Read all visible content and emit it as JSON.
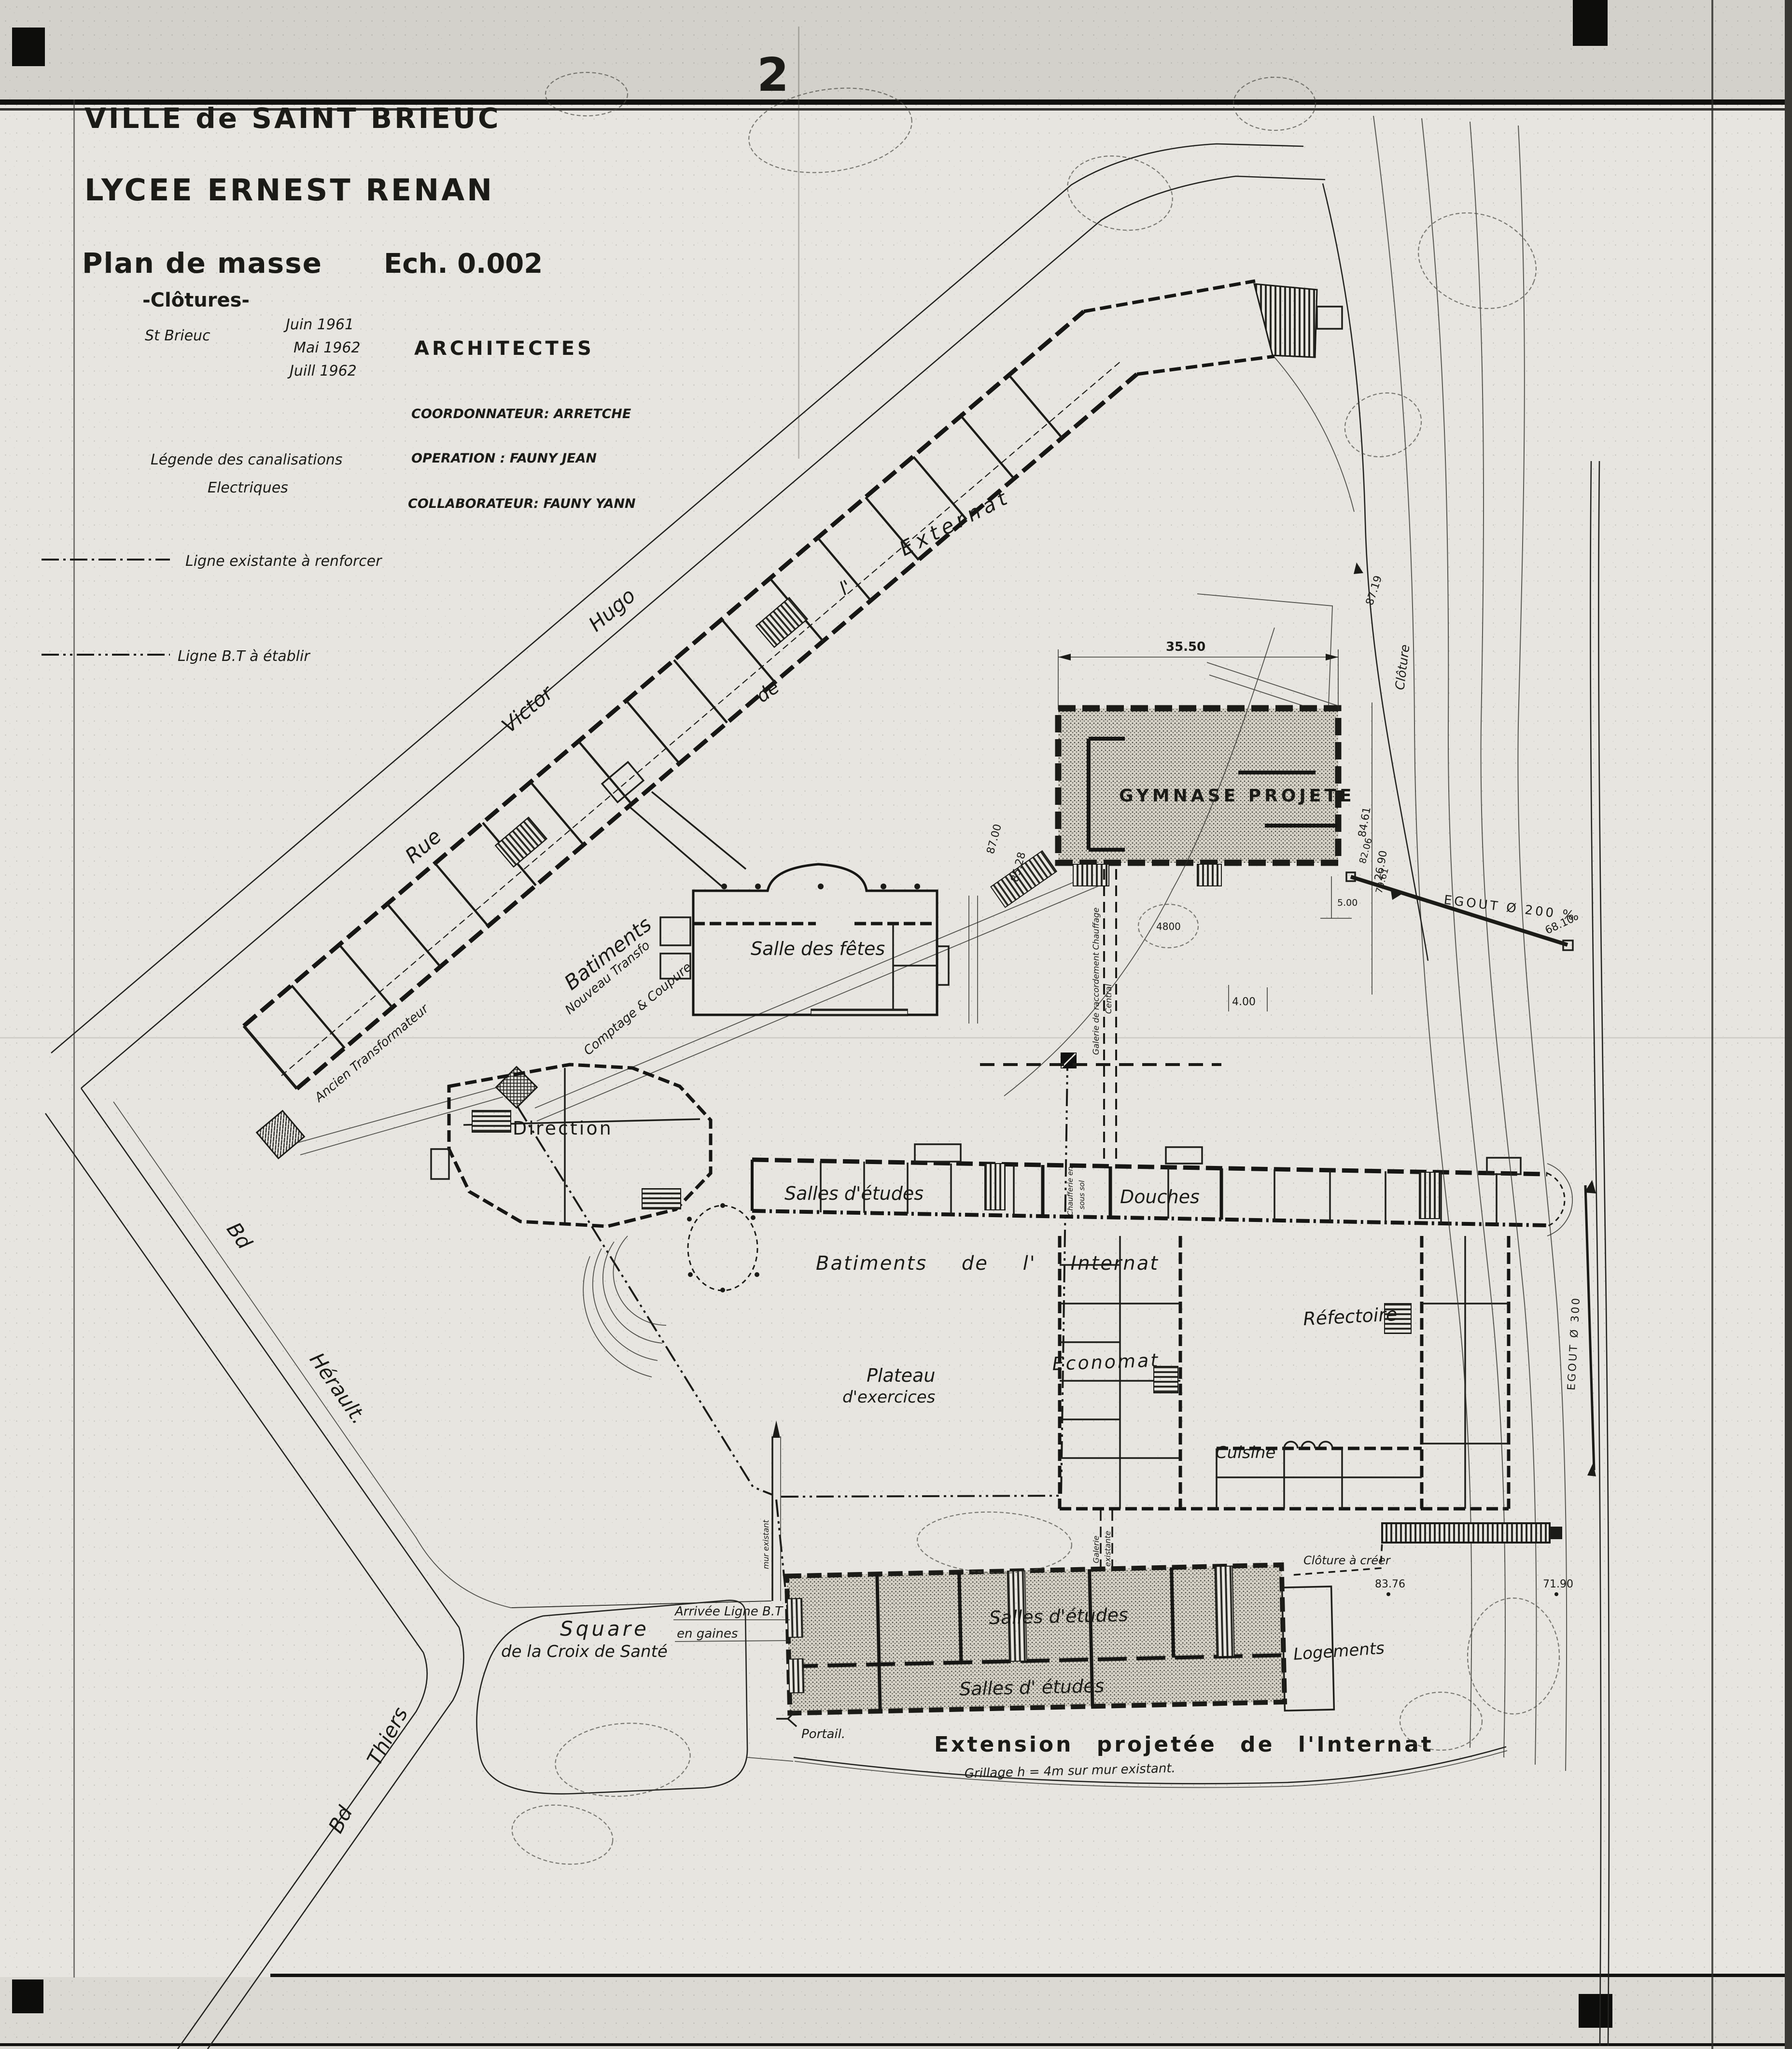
{
  "page": {
    "sheet_number": "2"
  },
  "title_block": {
    "city": "VILLE de SAINT BRIEUC",
    "school": "LYCEE ERNEST RENAN",
    "plan_title": "Plan de masse",
    "plan_subtitle": "-Clôtures-",
    "scale": "Ech. 0.002",
    "place": "St Brieuc",
    "date1": "Juin 1961",
    "date2": "Mai 1962",
    "date3": "Juill 1962",
    "architects_heading": "ARCHITECTES",
    "architect_role1": "COORDONNATEUR: ARRETCHE",
    "architect_role2": "OPERATION : FAUNY JEAN",
    "architect_role3": "COLLABORATEUR: FAUNY YANN"
  },
  "legend": {
    "title_line1": "Légende des canalisations",
    "title_line2": "Electriques",
    "item1": "Ligne existante à renforcer",
    "item2": "Ligne B.T à établir"
  },
  "streets": {
    "rue": "Rue",
    "victor": "Victor",
    "hugo": "Hugo",
    "herault_bd": "Bd",
    "herault_name": "Hérault.",
    "thiers_bd": "Bd",
    "thiers_name": "Thiers"
  },
  "externat": {
    "word1": "Batiments",
    "word2": "de",
    "word3": "l'",
    "word4": "Externat"
  },
  "buildings": {
    "gymnase": "GYMNASE PROJETE",
    "salle_des_fetes": "Salle des fêtes",
    "direction": "Direction",
    "salles_etudes": "Salles d'études",
    "douches": "Douches",
    "chaufferie_l1": "Chaufferie en",
    "chaufferie_l2": "sous sol",
    "internat_caption": "Batiments de l' Internat",
    "refectoire": "Réfectoire",
    "economat": "Economat",
    "cuisine": "Cuisine",
    "plateau_l1": "Plateau",
    "plateau_l2": "d'exercices",
    "extension_salles1": "Salles d'études",
    "extension_salles2": "Salles d' études",
    "logements": "Logements",
    "extension_caption": "Extension projetée de l'Internat",
    "square_l1": "Square",
    "square_l2": "de la Croix de Santé"
  },
  "annotations": {
    "ancien_transfo": "Ancien Transformateur",
    "nouveau_transfo_l1": "Nouveau Transfo",
    "nouveau_transfo_l2": "Comptage & Coupure",
    "galerie_l1": "Galerie de raccordement Chauffage",
    "galerie_l2": "Central",
    "galerie_existante_l1": "Galerie",
    "galerie_existante_l2": "existante",
    "arrivee_l1": "Arrivée Ligne B.T",
    "arrivee_l2": "en gaines",
    "portail": "Portail.",
    "grillage": "Grillage h = 4m sur mur existant.",
    "cloture_a_creer": "Clôture à créer",
    "cloture": "Clôture",
    "mur": "mur existant",
    "egout_200": "EGOUT  Ø 200 ‰",
    "egout_300": "EGOUT  Ø 300"
  },
  "measurements": {
    "m35_50": "35.50",
    "m87_19": "87.19",
    "m84_61": "84.61",
    "m26_90": "26.90",
    "m87_00": "87.00",
    "m85_28": "85.28",
    "m82_06": "82.06",
    "m79_61": "79.61",
    "m5_00": "5.00",
    "m4_00": "4.00",
    "m68_10": "68.10",
    "m83_76": "83.76",
    "m71_90": "71.90",
    "m4800": "4800"
  }
}
